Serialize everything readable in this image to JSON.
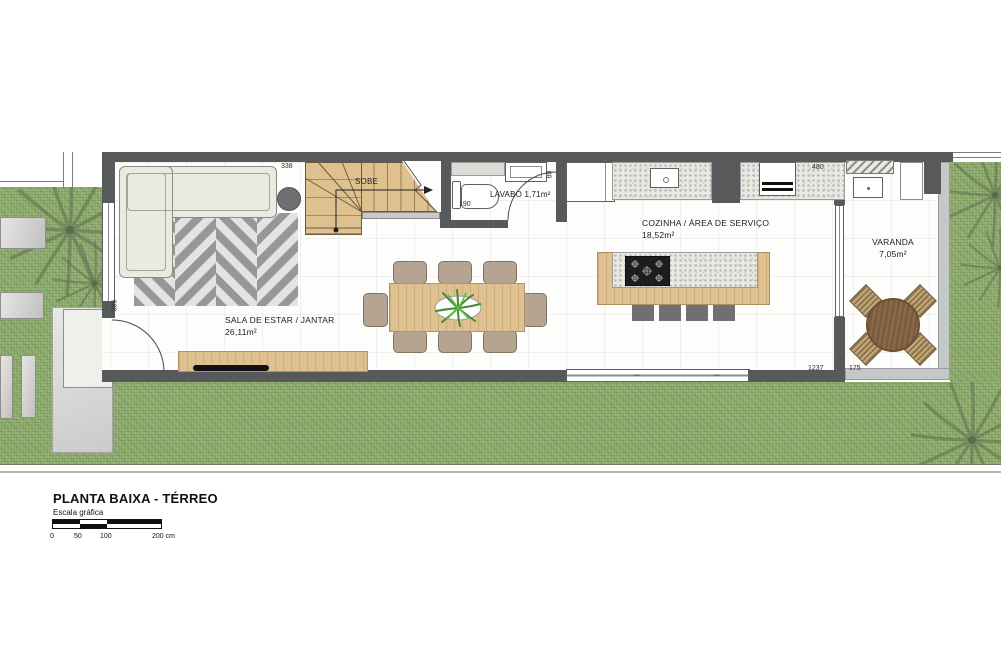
{
  "plan": {
    "title": "PLANTA BAIXA - TÉRREO",
    "scale_caption": "Escala gráfica",
    "scale_ticks": [
      "0",
      "50",
      "100",
      "200 cm"
    ]
  },
  "rooms": {
    "living": {
      "name": "SALA DE ESTAR / JANTAR",
      "area": "26,11m²"
    },
    "lavabo": {
      "label": "LAVABO 1,71m²"
    },
    "kitchen": {
      "name": "COZINHA / ÁREA DE SERVIÇO",
      "area": "18,52m²"
    },
    "varanda": {
      "name": "VARANDA",
      "area": "7,05m²"
    },
    "stairs": {
      "direction_label": "SOBE"
    }
  },
  "dimensions": {
    "living_width": "338",
    "living_height": "386",
    "lavabo_width": "190",
    "lavabo_door": "80",
    "kitchen_width": "480",
    "house_bottom_width": "1237",
    "varanda_width": "175"
  },
  "colors": {
    "wall": "#58595b",
    "varanda_wall": "#c6c7c9",
    "wood": "#dfc190",
    "granite": "#eae8e3",
    "grass": "#8fae6e",
    "sofa": "#eaeae1",
    "chair": "#b5a492",
    "stool": "#6f7073",
    "round_table": "#8a6848",
    "plant": "#4f9a3c"
  }
}
